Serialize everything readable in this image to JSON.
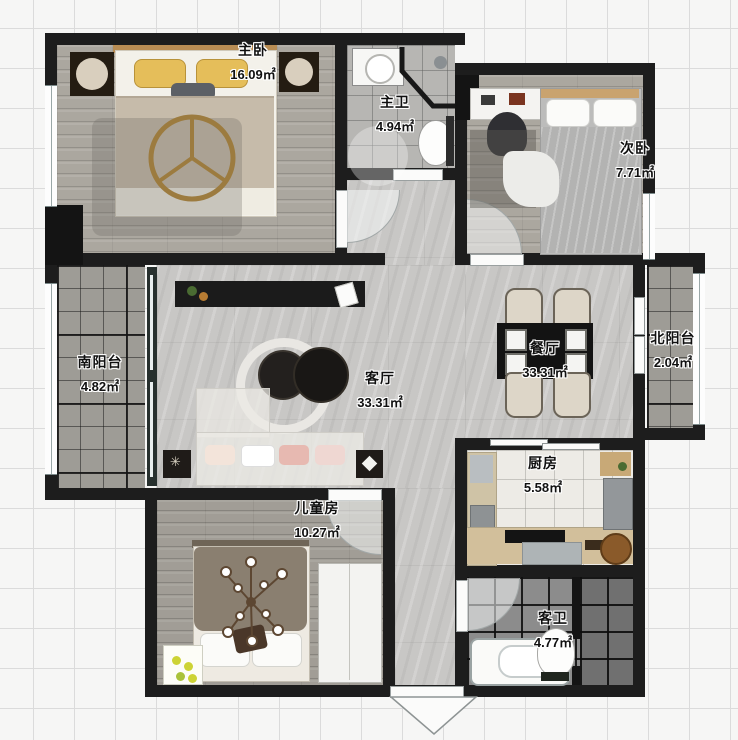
{
  "rooms": {
    "master_bedroom": {
      "name": "主卧",
      "area": "16.09㎡"
    },
    "master_bath": {
      "name": "主卫",
      "area": "4.94㎡"
    },
    "second_bedroom": {
      "name": "次卧",
      "area": "7.71㎡"
    },
    "south_balcony": {
      "name": "南阳台",
      "area": "4.82㎡"
    },
    "living_room": {
      "name": "客厅",
      "area": "33.31㎡"
    },
    "dining_room": {
      "name": "餐厅",
      "area": "33.31㎡"
    },
    "north_balcony": {
      "name": "北阳台",
      "area": "2.04㎡"
    },
    "kitchen": {
      "name": "厨房",
      "area": "5.58㎡"
    },
    "kids_room": {
      "name": "儿童房",
      "area": "10.27㎡"
    },
    "guest_bath": {
      "name": "客卫",
      "area": "4.77㎡"
    }
  },
  "colors": {
    "wall": "#1d1d1d",
    "floor_marble": "#c8c7c5",
    "pillow_accent_yellow": "#e5be5a",
    "wood_accent": "#c9a36f",
    "background_grid_line": "#dbdbdb"
  }
}
